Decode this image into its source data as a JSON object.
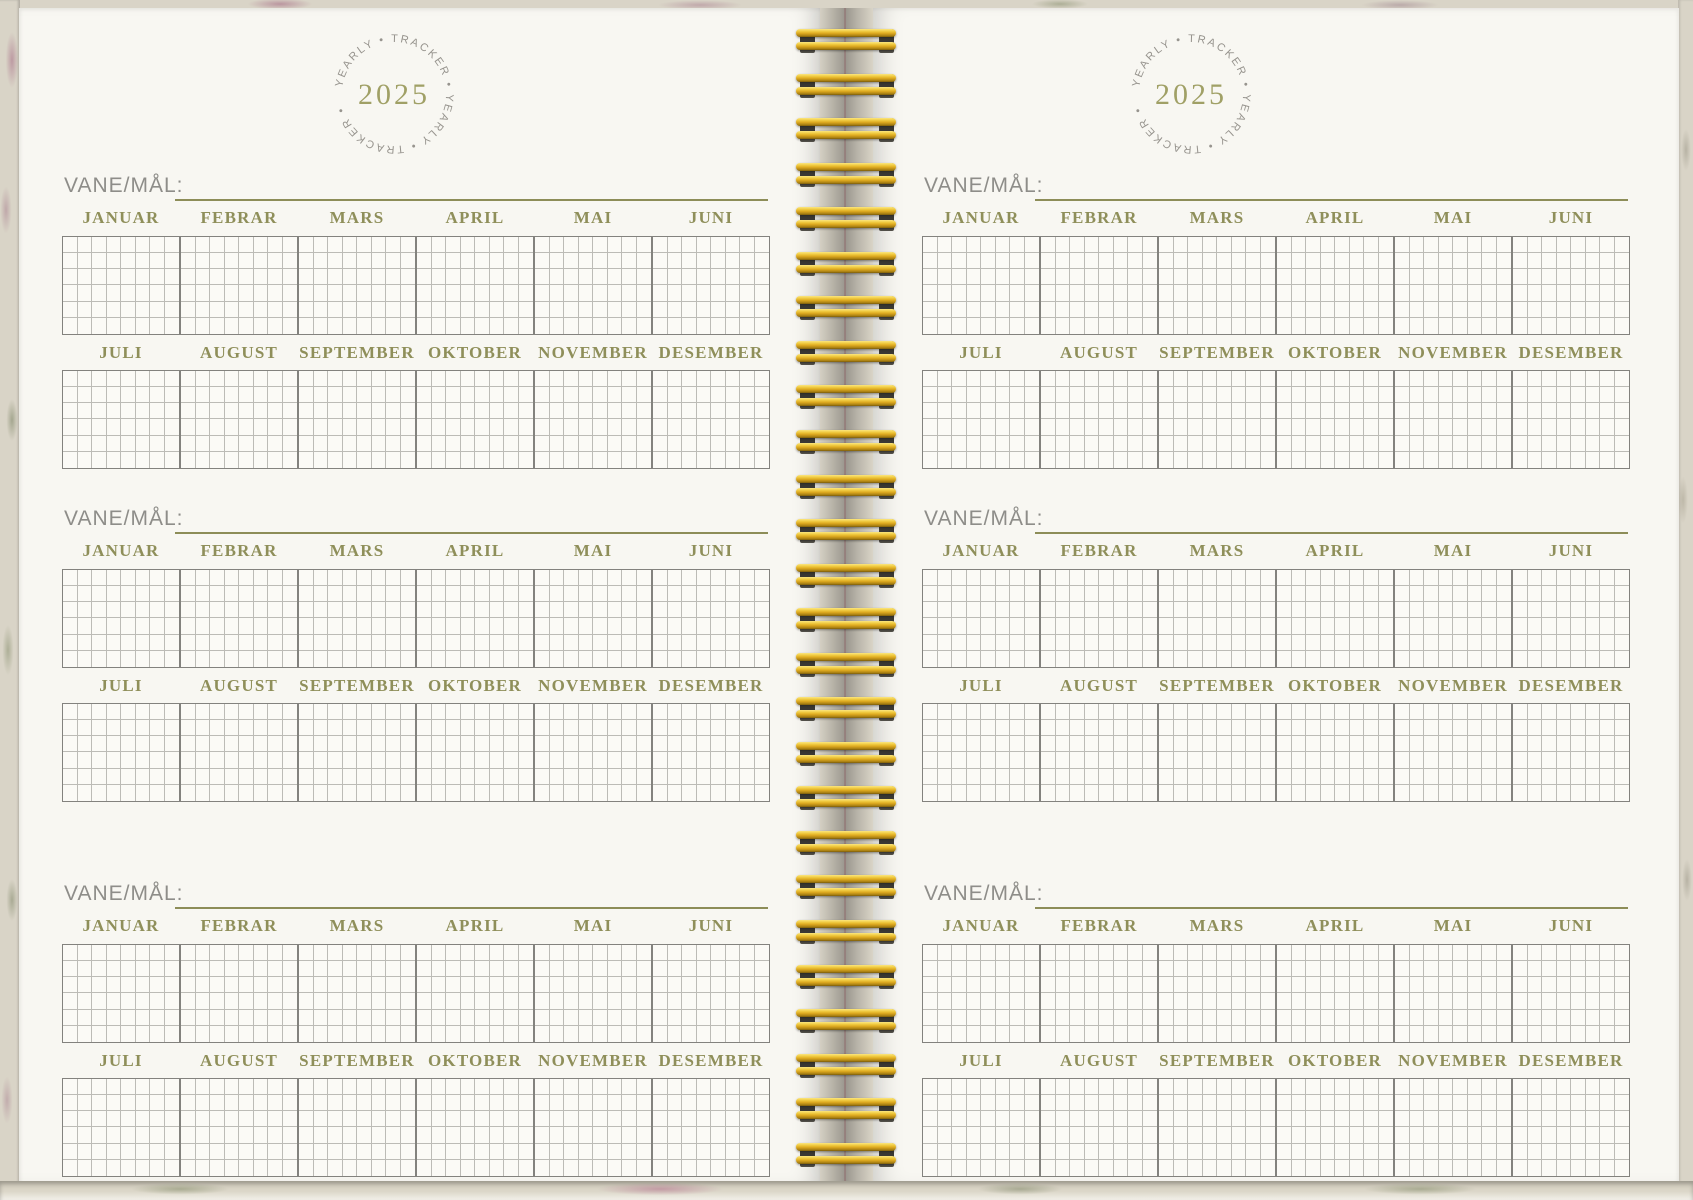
{
  "stamp": {
    "circle_text": "YEARLY • TRACKER • YEARLY • TRACKER • ",
    "year": "2025"
  },
  "tracker": {
    "label": "VANE/MÅL:",
    "months_top": [
      "JANUAR",
      "FEBRAR",
      "MARS",
      "APRIL",
      "MAI",
      "JUNI"
    ],
    "months_bottom": [
      "JULI",
      "AUGUST",
      "SEPTEMBER",
      "OKTOBER",
      "NOVEMBER",
      "DESEMBER"
    ],
    "sections_per_page": 3,
    "grid_rows": 6,
    "grid_cols_per_month": 8
  },
  "colors": {
    "accent_olive": "#8d8d58",
    "binding_gold": "#dca81f",
    "paper": "#f8f7f2",
    "cover": "#d9d4c7"
  },
  "pages": [
    {
      "id": "left"
    },
    {
      "id": "right"
    }
  ]
}
